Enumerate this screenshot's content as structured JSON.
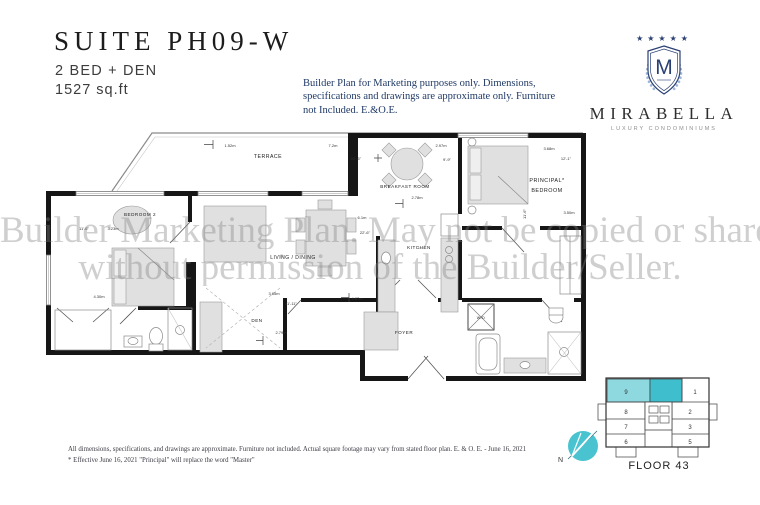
{
  "header": {
    "suite_title": "SUITE PH09-W",
    "bed_config": "2 BED + DEN",
    "area": "1527 sq.ft",
    "disclaimer": "Builder Plan for Marketing purposes only. Dimensions, specifications and drawings are approximate only. Furniture not Included. E.&O.E."
  },
  "logo": {
    "stars": "★★★★★",
    "monogram": "M",
    "name": "MIRABELLA",
    "tagline": "LUXURY CONDOMINIUMS",
    "navy": "#2a4073",
    "light_blue": "#9db6d8"
  },
  "watermark": {
    "line1": "Builder Marketing Plan. May not be copied or shared",
    "line2": "without permission of the Builder/Seller."
  },
  "floorplan": {
    "rooms": {
      "terrace": "TERRACE",
      "bedroom2": "BEDROOM 2",
      "living_dining": "LIVING / DINING",
      "breakfast": "BREAKFAST ROOM",
      "kitchen": "KITCHEN",
      "principal_line1": "PRINCIPAL*",
      "principal_line2": "BEDROOM",
      "den": "DEN",
      "foyer": "FOYER",
      "wd": "W/D"
    },
    "dims": {
      "terrace_w": "1.52m",
      "terrace_l": "7.2m",
      "living_w_ft": "22'-6\"",
      "breakfast_w": "2.97m",
      "breakfast_w_ft": "9'-9\"",
      "breakfast_d": "2.78m",
      "principal_w": "3.68m",
      "principal_w_ft": "12'-1\"",
      "principal_d": "3.50m",
      "principal_d_ft": "11'-6\"",
      "living_l": "6.1m",
      "living_l_ft": "22'-6\"",
      "bedroom2_w_ft": "11'-6\"",
      "bedroom2_w": "3.23m",
      "bedroom2_l": "4.30m",
      "den_w": "3.65m",
      "den_w_ft": "11'-11\"",
      "den_d": "2.79m",
      "kitchen_l": "4.87m"
    }
  },
  "keyplate": {
    "floor": "FLOOR 43",
    "north": "N",
    "highlight_color": "#3fbfce",
    "units": [
      "9",
      "1",
      "8",
      "2",
      "7",
      "3",
      "6",
      "5"
    ]
  },
  "footer": {
    "line1": "All dimensions, specifications, and drawings are approximate. Furniture not included. Actual square footage may vary from stated floor plan. E. & O. E. - June 16, 2021",
    "line2": "* Effective June 16, 2021 \"Principal\" will replace the word \"Master\""
  }
}
